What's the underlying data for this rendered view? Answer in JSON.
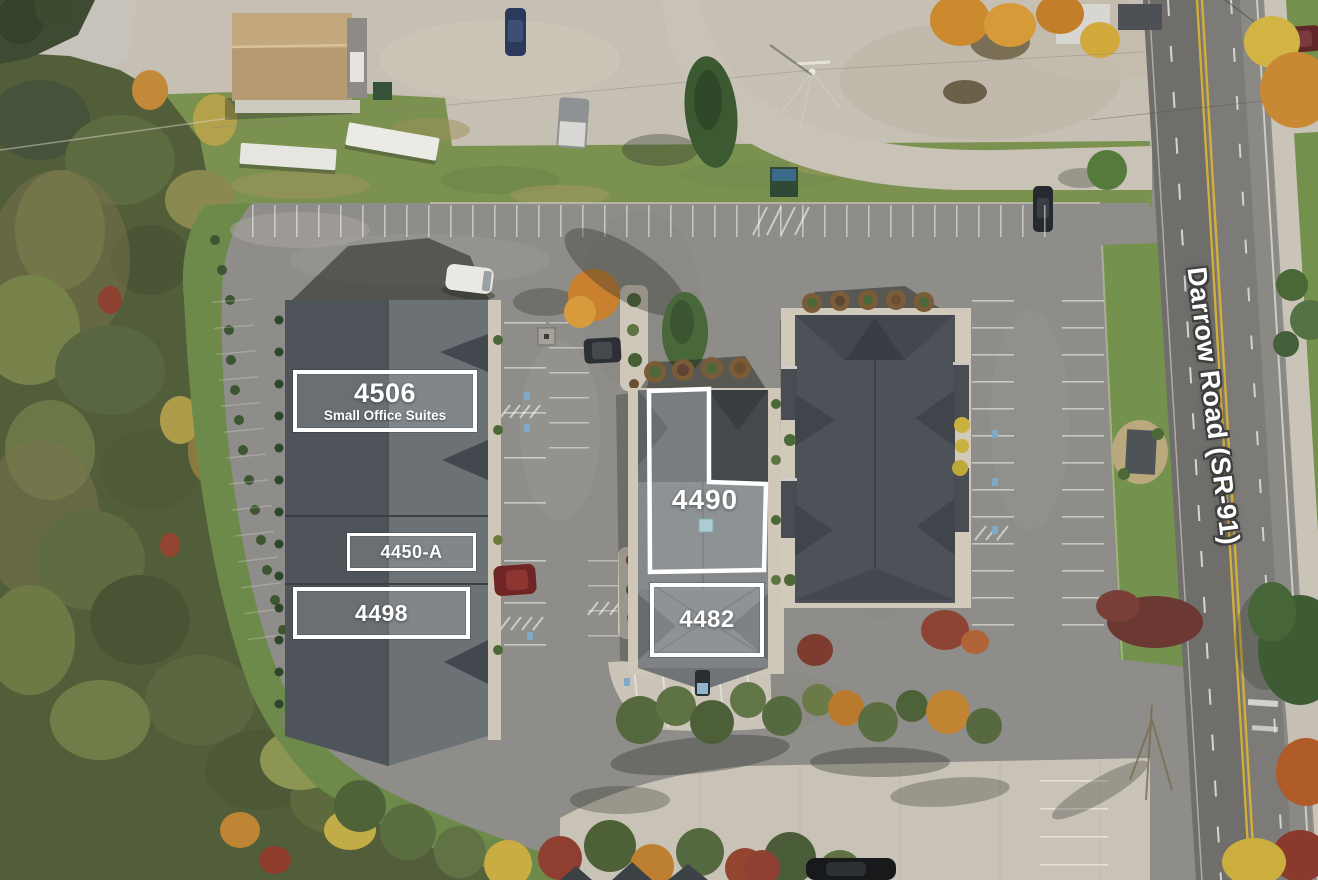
{
  "scene": {
    "description": "Aerial drone photo of an office condo complex in autumn with labeled unit addresses",
    "road_label": "Darrow Road (SR-91)"
  },
  "units": {
    "u4506": {
      "address": "4506",
      "subtitle": "Small Office Suites"
    },
    "u4450a": {
      "address": "4450-A"
    },
    "u4490": {
      "address": "4490"
    },
    "u4498": {
      "address": "4498"
    },
    "u4482": {
      "address": "4482"
    }
  },
  "colors": {
    "label_border": "#ffffff",
    "label_text": "#ffffff",
    "road_label_text": "#ffffff",
    "road_label_outline": "#3e3e3e",
    "road_centerline": "#d2ae3a"
  }
}
